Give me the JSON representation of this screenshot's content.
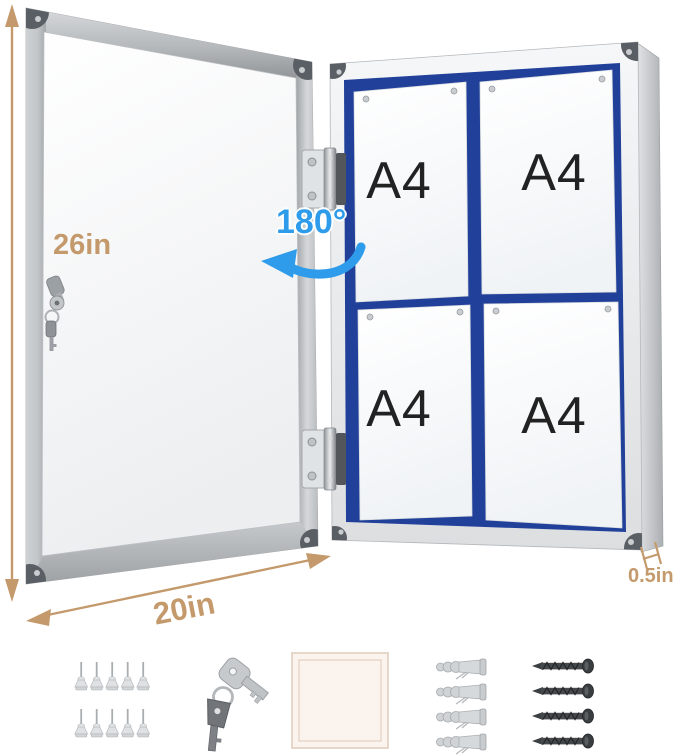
{
  "annotations": {
    "height": "26in",
    "width": "20in",
    "depth": "0.5in",
    "door_swing": "180°"
  },
  "board": {
    "sheets": [
      {
        "label": "A4"
      },
      {
        "label": "A4"
      },
      {
        "label": "A4"
      },
      {
        "label": "A4"
      }
    ]
  },
  "accessories": {
    "push_pins": {
      "count": 10,
      "per_row": 5
    },
    "keys": {
      "count": 2
    },
    "note_pad": {
      "count": 1
    },
    "wall_anchors": {
      "count": 4
    },
    "screws": {
      "count": 4
    }
  },
  "colors": {
    "tan": "#c49a6c",
    "blue": "#2f9ceb",
    "felt": "#21409a",
    "pad": "#fbf3ed"
  }
}
